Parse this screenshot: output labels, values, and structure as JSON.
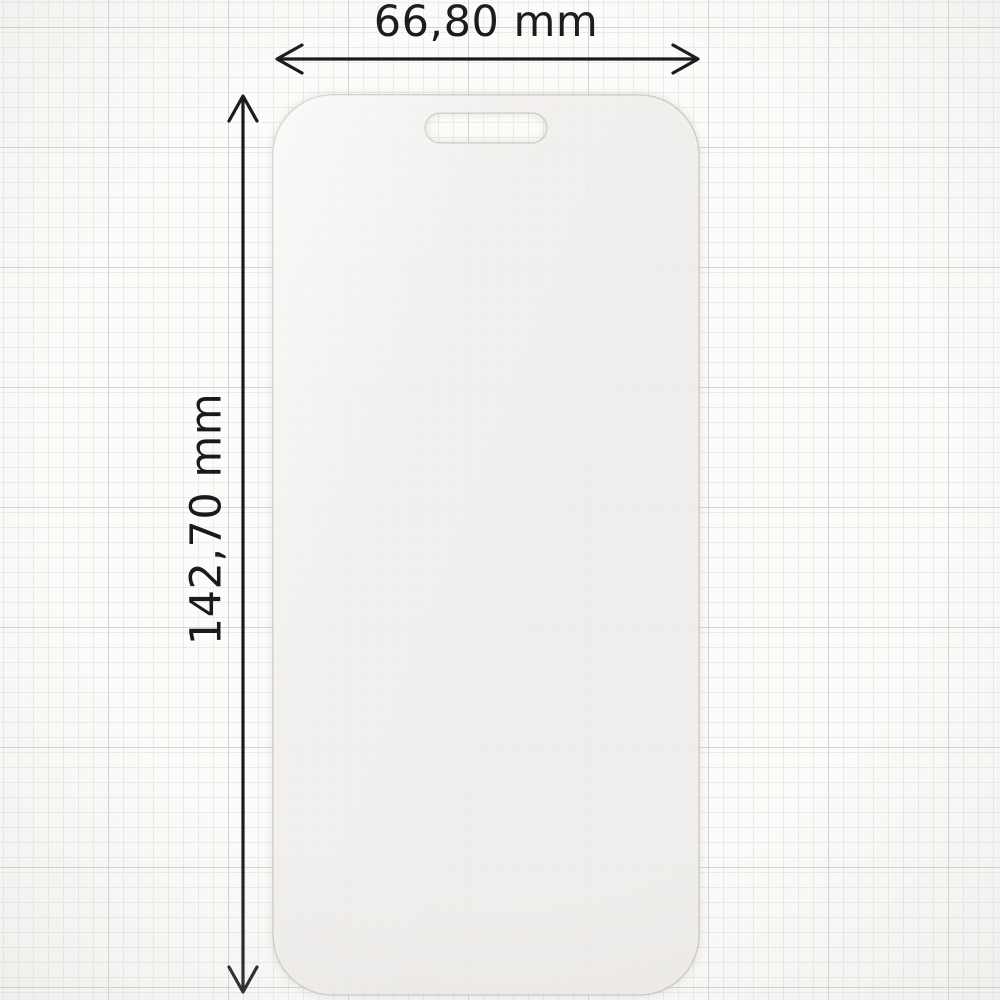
{
  "image_type": "screen-protector-dimension-diagram",
  "annotations": {
    "width_label": "66,80 mm",
    "height_label": "142,70 mm"
  },
  "dimensions": {
    "width_mm": 66.8,
    "height_mm": 142.7,
    "unit": "mm"
  },
  "colors": {
    "background": "#fcfcfb",
    "grid_minor": "#ebebe8",
    "grid_major": "#d4d3d1",
    "dimension_line": "#1a1a1a",
    "glass_tint": "#f2f0ed",
    "glass_tint_rgba": "rgba(242,240,237,0.85)",
    "glass_edge": "rgba(181,176,169,0.55)"
  }
}
